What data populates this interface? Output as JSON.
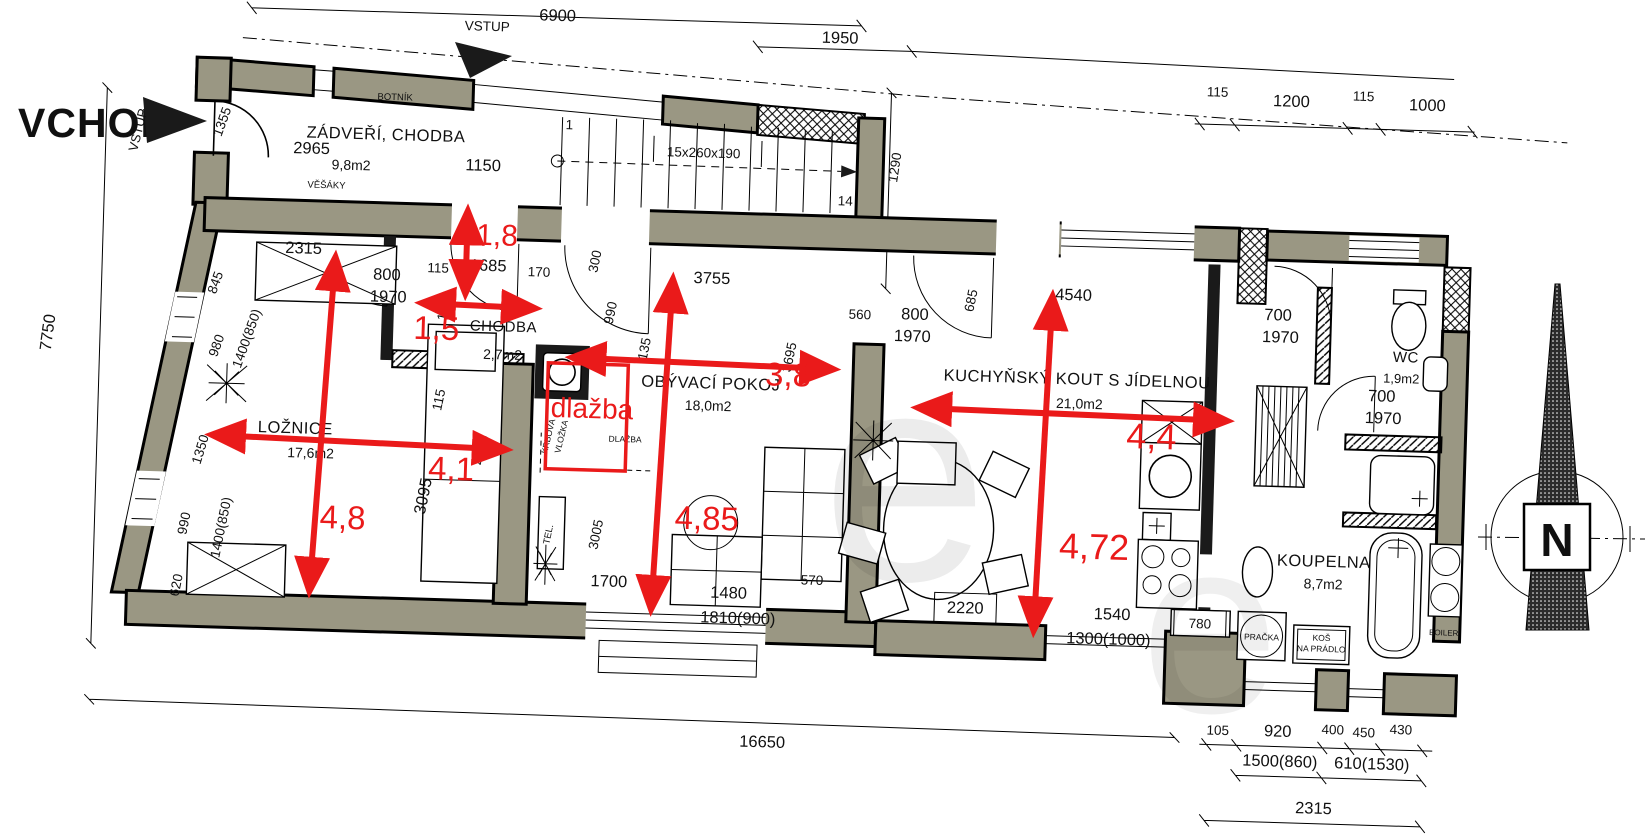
{
  "colors": {
    "wall": "#9a9783",
    "red": "#ea1a1a",
    "entry_red": "#a82020"
  },
  "red": {
    "vchod": "VCHOD",
    "a18": "1,8",
    "a15": "1,5",
    "a41": "4,1",
    "a48": "4,8",
    "a485": "4,85",
    "a38": "3,8",
    "a44": "4,4",
    "a472": "4,72",
    "dlazba": "dlažba"
  },
  "rooms": {
    "zadveri": {
      "name": "ZÁDVEŘÍ, CHODBA",
      "area": "9,8m2"
    },
    "chodba": {
      "name": "CHODBA",
      "area": "2,7m2"
    },
    "loznice": {
      "name": "LOŽNICE",
      "area": "17,6m2"
    },
    "obyvaci": {
      "name": "OBÝVACÍ POKOJ",
      "area": "18,0m2"
    },
    "kuchyn": {
      "name": "KUCHYŇSKÝ KOUT S JÍDELNOU",
      "area": "21,0m2"
    },
    "wc": {
      "name": "WC",
      "area": "1,9m2"
    },
    "koupelna": {
      "name": "KOUPELNA",
      "area": "8,7m2"
    }
  },
  "fixtures": {
    "botnik": "BOTNÍK",
    "vesaky": "VĚŠÁKY",
    "tel": "TEL.",
    "krbova1": "KRBOVÁ",
    "krbova2": "VLOŽKA",
    "dlazba_small": "DLAŽBA",
    "pracka": "PRAČKA",
    "kos1": "KOŠ",
    "kos2": "NA PRÁDLO",
    "boiler": "BOILER",
    "stairs": "15x260x190",
    "stair_first": "1",
    "stair_last": "14",
    "vstup": "VSTUP",
    "north": "N",
    "watermark": "e"
  },
  "dims": {
    "top_width": "6900",
    "stair_width": "1950",
    "right_offset": "1290",
    "tr_115": "115",
    "tr_1200": "1200",
    "tr_1000": "1000",
    "left_height": "7750",
    "entry_door": "1355",
    "e_2965": "2965",
    "e_1150": "1150",
    "bed_2315": "2315",
    "bed_845": "845",
    "bed_980": "980",
    "w_1400_850": "1400(850)",
    "bed_1350": "1350",
    "bed_990": "990",
    "bed_620": "620",
    "bed_3095": "3095",
    "bed_4755": "4755",
    "n_115": "115",
    "d_800": "800",
    "d_1970": "1970",
    "ch_1685": "1685",
    "ch_170": "170",
    "ch_1580": "1580",
    "l_300": "300",
    "l_990": "990",
    "l_3755": "3755",
    "l_3695": "3695",
    "l_135": "135",
    "l_3005": "3005",
    "l_1700": "1700",
    "l_1480": "1480",
    "l_570": "570",
    "l_1810": "1810(900)",
    "k_560": "560",
    "k_685": "685",
    "k_4540": "4540",
    "k_2220": "2220",
    "k_1540": "1540",
    "k_1300": "1300(1000)",
    "k_780": "780",
    "wc_700": "700",
    "total": "16650",
    "b_105": "105",
    "b_920": "920",
    "b_400": "400",
    "b_450": "450",
    "b_430": "430",
    "b_1500": "1500(860)",
    "b_610": "610(1530)",
    "b_2315": "2315"
  }
}
